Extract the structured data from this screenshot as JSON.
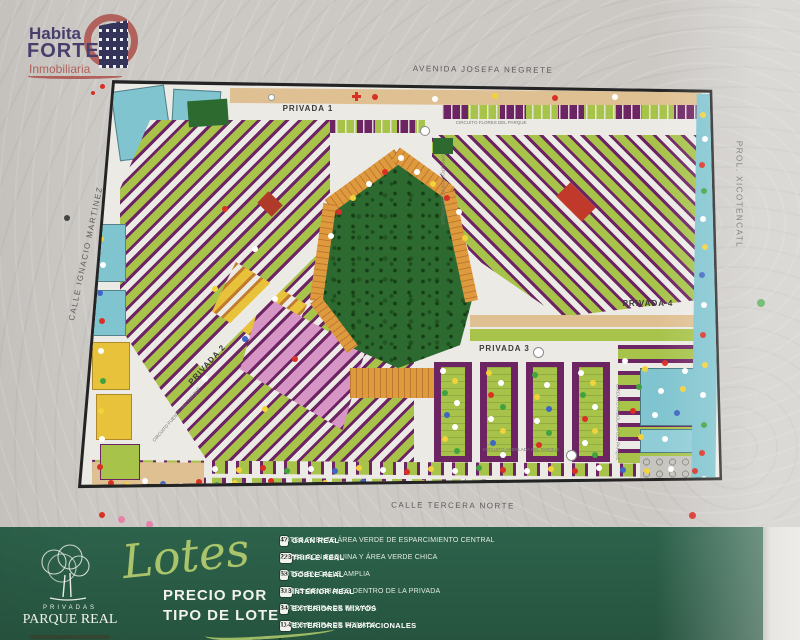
{
  "brand": {
    "line1": "Habita",
    "line2": "FORTE",
    "line3": "Inmobiliaria"
  },
  "map": {
    "streets": {
      "top": "AVENIDA JOSEFA NEGRETE",
      "left": "CALLE IGNACIO MARTINEZ",
      "right": "PROL. XICOTENCATL",
      "bottom": "CALLE TERCERA NORTE"
    },
    "privadas": [
      "PRIVADA 1",
      "PRIVADA 2",
      "PRIVADA 3",
      "PRIVADA 4"
    ],
    "circuits": [
      "CIRCUITO FLORES DEL PARQUE",
      "CIRCUITO PASEOS DEL PARQUE",
      "CIRCUITO ARBOLADA DEL PARQUE",
      "CIRCUITO FUENTE DEL PARQUE"
    ],
    "park_color": "#2d6a2f",
    "water_color": "#7fc4cf"
  },
  "legend": {
    "logo": {
      "privadas": "PRIVADAS",
      "name": "PARQUE REAL"
    },
    "script_title": "Lotes",
    "subtitle_line1": "PRECIO POR",
    "subtitle_line2": "TIPO DE LOTE",
    "partial_row_color": "#5a2a52",
    "rows": [
      {
        "count": "47",
        "name": "GRAN REAL",
        "desc": "LOTES FRENTE ÁREA VERDE DE ESPARCIMIENTO CENTRAL",
        "color": "#e09a3e"
      },
      {
        "count": "228",
        "name": "TRIPLE REAL",
        "desc": "LOTES CON ESQUINA Y ÁREA VERDE CHICA",
        "color": "#6d2463"
      },
      {
        "count": "58",
        "name": "DOBLE REAL",
        "desc": "LOTES EN CALLE AMPLIA",
        "color": "#d795c6"
      },
      {
        "count": "318",
        "name": "INTERIOR REAL",
        "desc": "LOTES GENERALES DENTRO DE LA PRIVADA",
        "color": "#a7c34a"
      },
      {
        "count": "34",
        "name": "EXTERIORES MIXTOS",
        "desc": "LOTES FUERA DE PRIVADA",
        "color": "#7fc4cf"
      },
      {
        "count": "114",
        "name": "EXTERIORES HABITACIONALES",
        "desc": "LOTES FUERA DE PRIVADA",
        "color": "#dfc092"
      }
    ]
  }
}
